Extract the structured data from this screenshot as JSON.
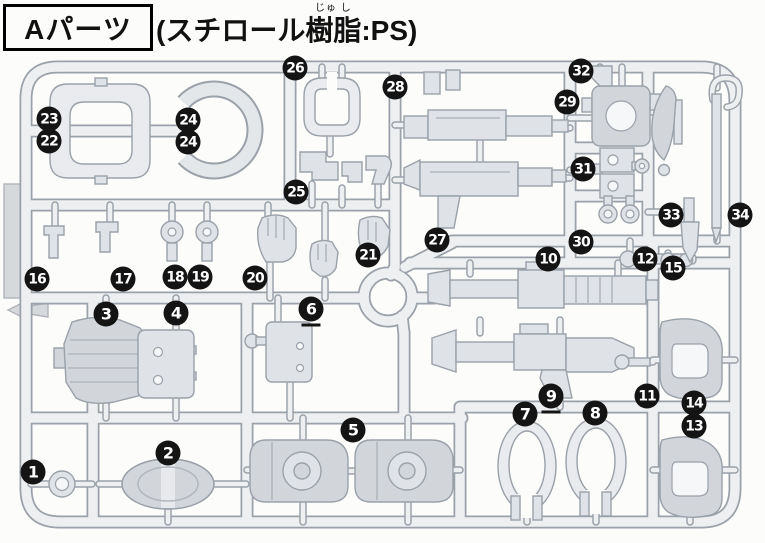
{
  "header": {
    "title": "Aパーツ",
    "material_prefix": "(スチロール",
    "material_word": "樹脂",
    "material_ruby": "じゅ し",
    "material_suffix": ":PS)"
  },
  "colors": {
    "badge": "#141414",
    "outline": "#9aa1a9",
    "rail_fill": "#edeff1",
    "part_fill": "#dfe2e6",
    "part_dark": "#d2d6db",
    "paper": "#fcfcfa"
  },
  "badges": [
    {
      "label": "1",
      "x": 33,
      "y": 472
    },
    {
      "label": "2",
      "x": 168,
      "y": 453
    },
    {
      "label": "3",
      "x": 106,
      "y": 314
    },
    {
      "label": "4",
      "x": 176,
      "y": 313
    },
    {
      "label": "5",
      "x": 353,
      "y": 430
    },
    {
      "label": "6",
      "x": 311,
      "y": 309,
      "underlined": true
    },
    {
      "label": "7",
      "x": 525,
      "y": 414
    },
    {
      "label": "8",
      "x": 595,
      "y": 413
    },
    {
      "label": "9",
      "x": 551,
      "y": 396,
      "underlined": true
    },
    {
      "label": "10",
      "x": 548,
      "y": 259
    },
    {
      "label": "11",
      "x": 647,
      "y": 396
    },
    {
      "label": "12",
      "x": 645,
      "y": 259
    },
    {
      "label": "13",
      "x": 694,
      "y": 426
    },
    {
      "label": "14",
      "x": 694,
      "y": 403
    },
    {
      "label": "15",
      "x": 673,
      "y": 268
    },
    {
      "label": "16",
      "x": 37,
      "y": 279
    },
    {
      "label": "17",
      "x": 123,
      "y": 279
    },
    {
      "label": "18",
      "x": 175,
      "y": 277
    },
    {
      "label": "19",
      "x": 200,
      "y": 277
    },
    {
      "label": "20",
      "x": 255,
      "y": 278
    },
    {
      "label": "21",
      "x": 368,
      "y": 255
    },
    {
      "label": "22",
      "x": 49,
      "y": 141
    },
    {
      "label": "23",
      "x": 49,
      "y": 119
    },
    {
      "label": "24",
      "x": 188,
      "y": 120
    },
    {
      "label": "24",
      "x": 188,
      "y": 142
    },
    {
      "label": "25",
      "x": 296,
      "y": 192
    },
    {
      "label": "26",
      "x": 295,
      "y": 68
    },
    {
      "label": "27",
      "x": 437,
      "y": 240
    },
    {
      "label": "28",
      "x": 395,
      "y": 87
    },
    {
      "label": "29",
      "x": 567,
      "y": 102
    },
    {
      "label": "30",
      "x": 581,
      "y": 242
    },
    {
      "label": "31",
      "x": 583,
      "y": 169
    },
    {
      "label": "32",
      "x": 581,
      "y": 71
    },
    {
      "label": "33",
      "x": 671,
      "y": 215
    },
    {
      "label": "34",
      "x": 740,
      "y": 215
    }
  ]
}
